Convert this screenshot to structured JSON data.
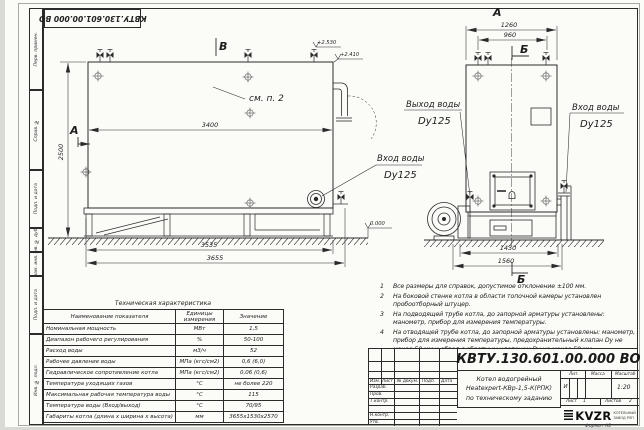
{
  "stamp_top": "КВТУ.130.601.00.000 ВО",
  "side_strip": {
    "labels": [
      "Перв. примен.",
      "Справ. №",
      "Подп. и дата",
      "Инв. № дубл.",
      "Взам. инв. №",
      "Подп. и дата",
      "Инв. № подл."
    ]
  },
  "side_view": {
    "section_b": "В",
    "section_a": "А",
    "see_note": "см. п. 2",
    "dim_length_top": "3400",
    "dim_height": "2500",
    "dim_base": "3535",
    "dim_overall": "3655",
    "elev_top1": "+2.530",
    "elev_top2": "+2.410",
    "elev_zero": "0.000",
    "inlet_line1": "Вход воды",
    "inlet_line2": "Dy125"
  },
  "front_view": {
    "view_label": "А",
    "section_b_top": "Б",
    "section_b_bottom": "Б",
    "dim_width_overall": "1260",
    "dim_width_valves": "960",
    "dim_base": "1430",
    "dim_overall": "1560",
    "outlet_line1": "Выход воды",
    "outlet_line2": "Dy125",
    "inlet_line1": "Вход воды",
    "inlet_line2": "Dy125"
  },
  "tech_table": {
    "title": "Техническая характеристика",
    "col_name": "Наименование показателя",
    "col_unit1": "Единицы",
    "col_unit2": "измерения",
    "col_value": "Значение",
    "rows": [
      {
        "name": "Номинальная мощность",
        "unit": "МВт",
        "value": "1,5"
      },
      {
        "name": "Диапазон рабочего регулирования",
        "unit": "%",
        "value": "50-100"
      },
      {
        "name": "Расход воды",
        "unit": "м3/ч",
        "value": "52"
      },
      {
        "name": "Рабочее давление воды",
        "unit": "МПа (кгс/см2)",
        "value": "0,6 (6,0)"
      },
      {
        "name": "Гидравлическое сопротивление котла",
        "unit": "МПа (кгс/см2)",
        "value": "0,06 (0,6)"
      },
      {
        "name": "Температура уходящих газов",
        "unit": "°С",
        "value": "не более 220"
      },
      {
        "name": "Максимальная рабочая температура воды",
        "unit": "°С",
        "value": "115"
      },
      {
        "name": "Температура воды (Вход/выход)",
        "unit": "°С",
        "value": "70/95"
      },
      {
        "name": "Габариты котла (длина х ширина х высота)",
        "unit": "мм",
        "value": "3655х1530х2570"
      }
    ]
  },
  "notes": {
    "items": [
      {
        "num": "1",
        "text": "Все размеры для справок, допустимое отклонение ±100 мм."
      },
      {
        "num": "2",
        "text": "На боковой стенке котла в области топочной камеры установлен пробоотборный штуцер."
      },
      {
        "num": "3",
        "text": "На подводящей трубе котла, до запорной арматуры установлены: манометр, прибор для измерения температуры."
      },
      {
        "num": "4",
        "text": "На отводящей трубе котла, до запорной арматуры установлены: манометр, прибор для измерения температуры, предохранительный клапан Dу не менее 50 мм и обвод с обратным клапаном Dу не менее 50 мм."
      }
    ]
  },
  "title_block": {
    "code": "КВТУ.130.601.00.000 ВО",
    "name_line1": "Котел водогрейный",
    "name_line2": "Heatexpert-КВр-1,5-К(РПК)",
    "name_line3": "по техническому заданию",
    "col_izm": "Изм.",
    "col_list": "Лист",
    "col_doc": "№ докум.",
    "col_sign": "Подп.",
    "col_date": "Дата",
    "row_dev": "Разраб.",
    "row_check": "Пров.",
    "row_tcontr": "Т.контр.",
    "row_ncontr": "Н.контр.",
    "row_approve": "Утв.",
    "lit_header": "Лит.",
    "mass_header": "Масса",
    "scale_header": "Масштаб",
    "lit_value": "И",
    "scale_value": "1:20",
    "sheet_label": "Лист",
    "sheet_value": "1",
    "sheets_label": "Листов",
    "sheets_value": "2",
    "logo_text": "KVZR",
    "logo_sub1": "КОТЕЛЬНЫЙ",
    "logo_sub2": "ЗАВОД РЭП",
    "format_label": "Формат А3"
  }
}
